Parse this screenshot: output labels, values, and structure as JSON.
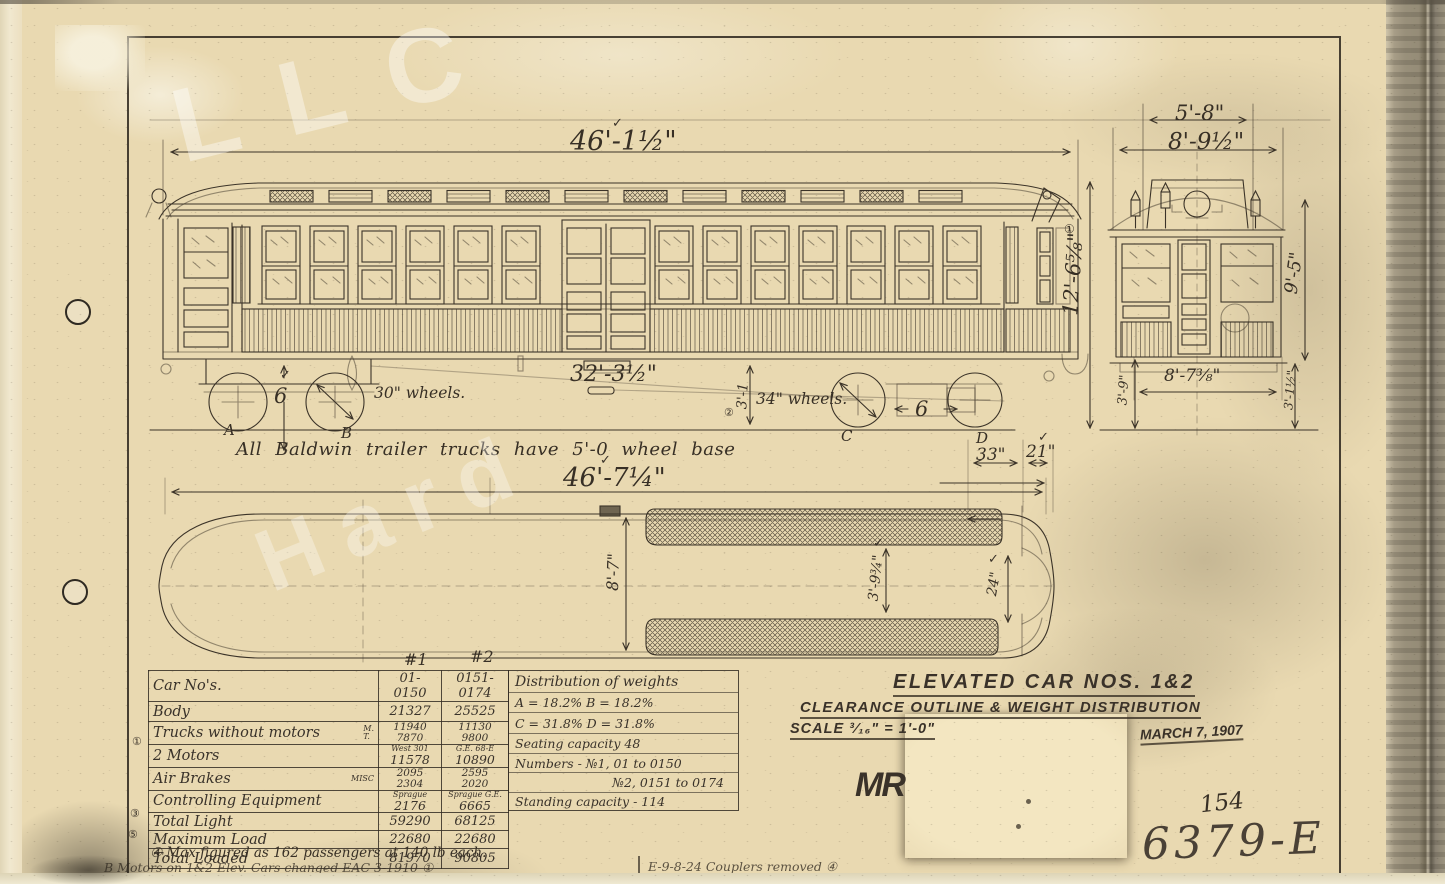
{
  "title_block": {
    "title": "ELEVATED CAR NOS. 1&2",
    "subtitle": "CLEARANCE OUTLINE & WEIGHT DISTRIBUTION",
    "scale": "SCALE  ³⁄₁₆\" = 1'-0\"",
    "date": "MARCH 7, 1907",
    "monogram": "MR",
    "sheet_number": "154",
    "drawing_number": "6379-E"
  },
  "drawing": {
    "note_baldwin": "All Baldwin trailer trucks have 5'-0 wheel base",
    "dims": {
      "car_length": "46'-1½\"",
      "end_width_upper": "5'-8\"",
      "end_width_lower": "8'-9½\"",
      "height_total": "12'-6⅝\"",
      "height_body": "9'-5\"",
      "truck_centers": "32'-3½\"",
      "truck_height": "3'-1",
      "wheels_trailer": "30\" wheels.",
      "wheels_motor": "34\" wheels.",
      "wheelbase_six": "6",
      "plan_length": "46'-7¼\"",
      "plan_33": "33\"",
      "plan_21": "21\"",
      "plan_width": "8'-7\"",
      "plan_aisle": "3'-9¾\"",
      "plan_24": "24\"",
      "end_39": "3'-9\"",
      "end_step": "8'-7⅜\"",
      "end_312": "3'-1½\""
    },
    "axle_labels": {
      "a": "A",
      "b": "B",
      "c": "C",
      "d": "D"
    }
  },
  "glyphs": {
    "check": "✓",
    "m1": "①",
    "m2": "②",
    "m3": "③",
    "m4": "④",
    "m5": "⑤"
  },
  "table": {
    "col1": "#1",
    "col2": "#2",
    "rows": [
      {
        "label": "Car No's.",
        "c1": "01-0150",
        "c2": "0151-0174"
      },
      {
        "label": "Body",
        "c1": "21327",
        "c2": "25525"
      },
      {
        "label": "Trucks without motors",
        "sub1": "M.",
        "sub2": "T.",
        "c1a": "11940",
        "c1b": "7870",
        "c2a": "11130",
        "c2b": "9800"
      },
      {
        "label": "2 Motors",
        "c1a": "West 301",
        "c1b": "11578",
        "c2a": "G.E. 68-E",
        "c2b": "10890"
      },
      {
        "label": "Air Brakes",
        "sub1": "MISC",
        "c1a": "2095",
        "c1b": "2304",
        "c2a": "2595",
        "c2b": "2020"
      },
      {
        "label": "Controlling Equipment",
        "c1a": "Sprague",
        "c1b": "2176",
        "c2a": "Sprague G.E.",
        "c2b": "6665"
      },
      {
        "label": "Total Light",
        "c1": "59290",
        "c2": "68125"
      },
      {
        "label": "Maximum Load",
        "c1": "22680",
        "c2": "22680"
      },
      {
        "label": "Total Loaded",
        "c1": "81970",
        "c2": "90805"
      }
    ]
  },
  "distribution": {
    "header": "Distribution of weights",
    "lines": [
      "A = 18.2%   B = 18.2%",
      "C = 31.8%   D = 31.8%",
      "Seating capacity  48",
      "Numbers - №1,  01 to 0150",
      "№2,  0151 to 0174",
      "Standing capacity - 114"
    ]
  },
  "notes": {
    "note1": "④ Max figured as 162 passengers at 140 lb each.",
    "note2a": "B  Motors on 1&2 Elev. Cars changed  EAC 3-1910 ①",
    "note2b": "E-9-8-24    Couplers removed ④"
  },
  "watermark": {
    "w1": "LLC",
    "w2": "Hard"
  }
}
